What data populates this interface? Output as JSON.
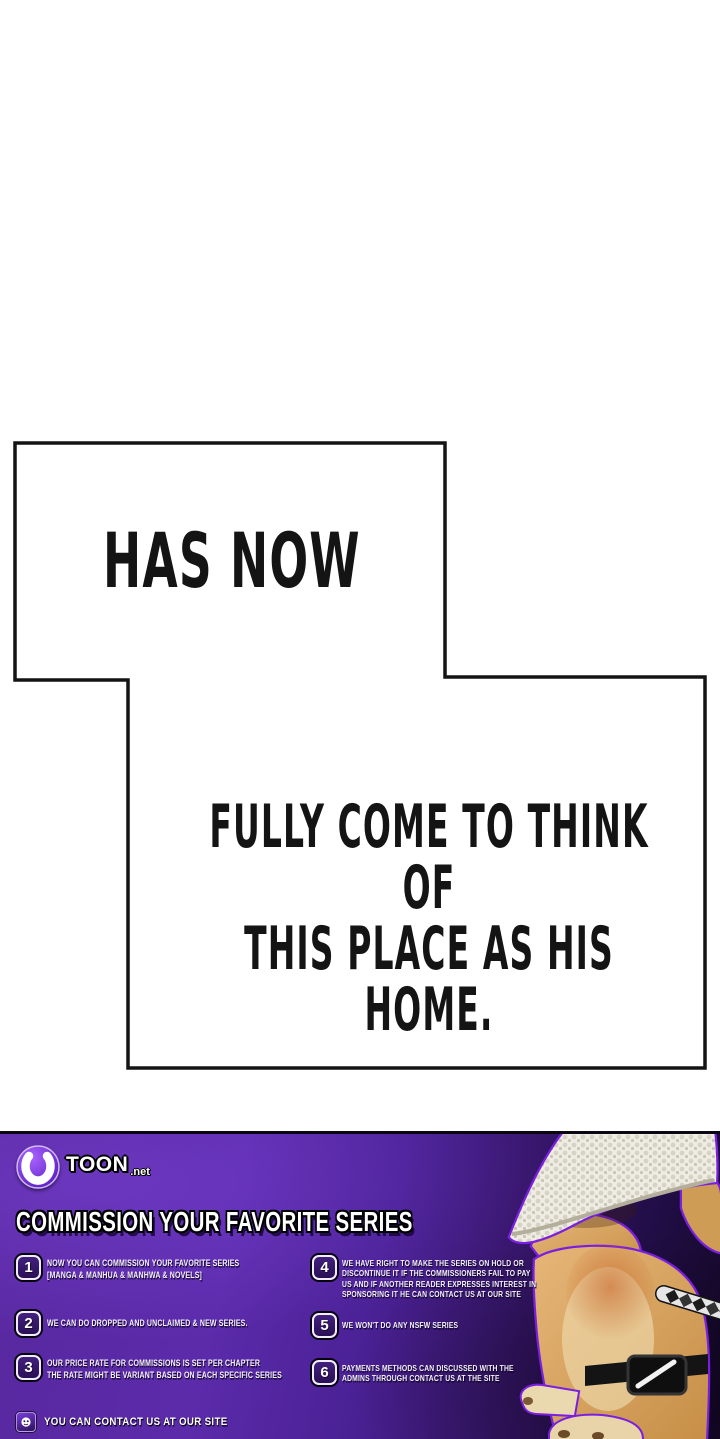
{
  "panel": {
    "bubble1": "HAS NOW",
    "bubble2": "FULLY COME TO THINK OF\nTHIS PLACE AS HIS HOME."
  },
  "footer": {
    "brand": {
      "name": "TOON",
      "tld": ".net",
      "logo_icon": "horseshoe-moon"
    },
    "heading": "COMMISSION YOUR FAVORITE SERIES",
    "items": [
      {
        "num": "1",
        "text": "NOW YOU CAN COMMISSION YOUR FAVORITE SERIES\n[MANGA & MANHUA & MANHWA  & NOVELS]"
      },
      {
        "num": "2",
        "text": "WE CAN DO DROPPED AND UNCLAIMED & NEW SERIES."
      },
      {
        "num": "3",
        "text": "OUR PRICE RATE FOR COMMISSIONS IS SET PER CHAPTER\nTHE RATE MIGHT BE VARIANT BASED ON EACH SPECIFIC SERIES"
      },
      {
        "num": "4",
        "text": "WE HAVE RIGHT TO MAKE THE SERIES ON HOLD OR\nDISCONTINUE IT IF THE COMMISSIONERS FAIL TO PAY\nUS AND IF ANOTHER READER EXPRESSES INTEREST IN\nSPONSORING IT  HE CAN CONTACT US AT OUR SITE"
      },
      {
        "num": "5",
        "text": "WE WON'T DO ANY NSFW SERIES"
      },
      {
        "num": "6",
        "text": "PAYMENTS METHODS CAN DISCUSSED WITH THE\nADMINS THROUGH CONTACT US AT THE SITE"
      }
    ],
    "contact": "YOU CAN CONTACT US AT OUR SITE",
    "mascot": "doge-with-straw-hat-and-katana",
    "colors": {
      "banner_purple": "#5a2aa8",
      "banner_dark": "#150828",
      "outline_accent": "#7a1fe0",
      "text": "#ffffff"
    }
  }
}
